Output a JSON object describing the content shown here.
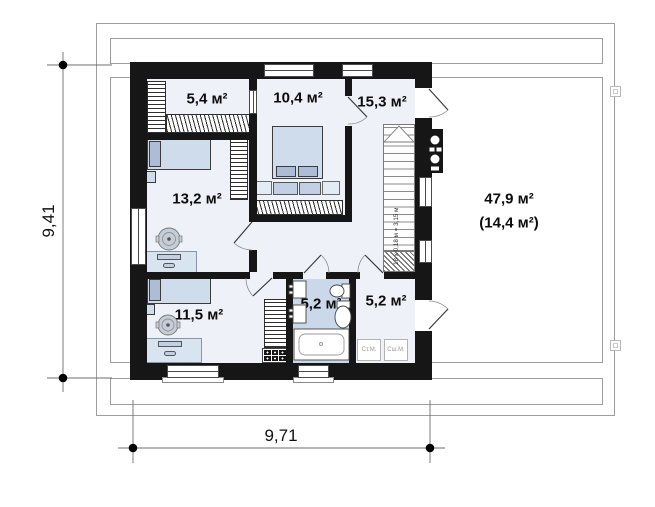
{
  "rooms": [
    {
      "id": "wardrobe",
      "label": "5,4 м²"
    },
    {
      "id": "bedroom-top",
      "label": "10,4 м²"
    },
    {
      "id": "hall",
      "label": "15,3 м²"
    },
    {
      "id": "bedroom-left",
      "label": "13,2 м²"
    },
    {
      "id": "bedroom-bottom",
      "label": "11,5 м²"
    },
    {
      "id": "bathroom",
      "label": "5,2 м²"
    },
    {
      "id": "laundry",
      "label": "5,2 м²"
    }
  ],
  "attic": {
    "label_total": "47,9 м²",
    "label_usable": "(14,4 м²)"
  },
  "stairs": {
    "note": "18 x 0,18 м = 3,15 м"
  },
  "dimensions": {
    "height": "9,41",
    "width": "9,71"
  },
  "appliances": {
    "washer": "Ст.М.",
    "dryer": "Сш.М."
  },
  "colors": {
    "wall": "#161616",
    "floor": "#eef2f8",
    "bathroom_floor": "#cbd8ea",
    "furniture": "#cfdcec",
    "outline": "#9e9e9e"
  }
}
